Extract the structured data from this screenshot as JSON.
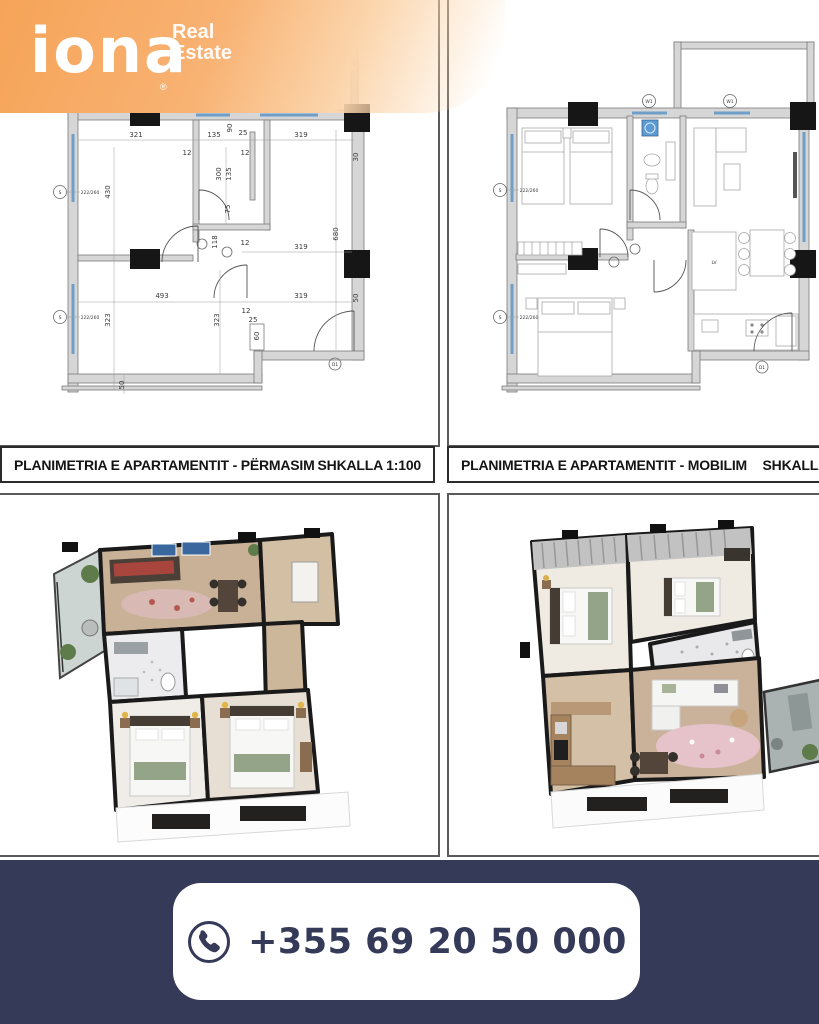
{
  "brand": {
    "logo": "iona",
    "registered": "®",
    "tagline_line1": "Real",
    "tagline_line2": "Estate"
  },
  "labels": {
    "left": {
      "title": "PLANIMETRIA E APARTAMENTIT - PËRMASIM",
      "scale": "SHKALLA 1:100"
    },
    "right": {
      "title": "PLANIMETRIA E APARTAMENTIT - MOBILIM",
      "scale": "SHKALLA 1:100"
    }
  },
  "contact": {
    "phone": "+355 69 20 50 000"
  },
  "colors": {
    "brand_orange": "#f6a458",
    "navy": "#343a58",
    "window_blue": "#6f9fc8",
    "wall_gray": "#d6d6d6"
  },
  "plan1": {
    "dims": {
      "v324": "324",
      "v20a": "20",
      "v180": "180",
      "v20b": "20",
      "v20c": "20",
      "v321": "321",
      "v135a": "135",
      "v90": "90",
      "v25a": "25",
      "v319a": "319",
      "v30": "30",
      "v12a": "12",
      "v12b": "12",
      "v430": "430",
      "v300": "300",
      "v135b": "135",
      "v75": "75",
      "v680": "680",
      "v319b": "319",
      "v12c": "12",
      "v118": "118",
      "v493": "493",
      "v319c": "319",
      "v50a": "50",
      "v323a": "323",
      "v323b": "323",
      "v12d": "12",
      "v25b": "25",
      "v60": "60",
      "v50b": "50"
    },
    "marks": {
      "w1": "W1",
      "s": "S",
      "win_size": "222/260",
      "d1": "D1"
    }
  },
  "plan2": {
    "marks": {
      "w1": "W1",
      "s": "S",
      "win_size": "222/260",
      "lv": "LV",
      "d1": "D1"
    }
  }
}
